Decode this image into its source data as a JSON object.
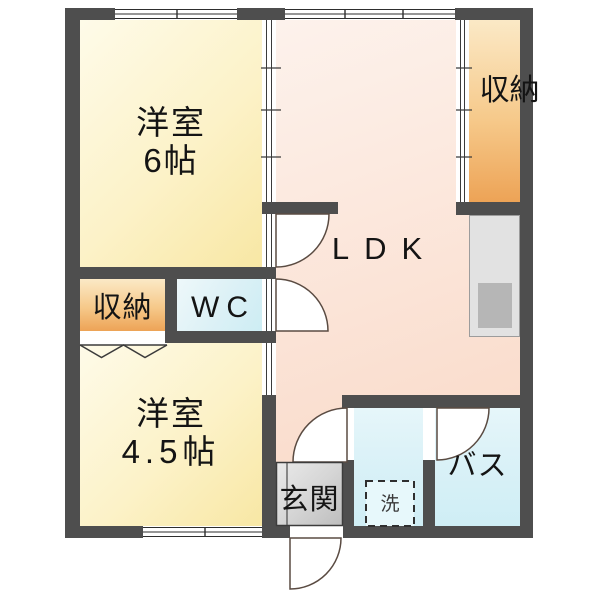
{
  "floorplan": {
    "type": "apartment-floor-plan",
    "rooms": {
      "western_room_6": {
        "name": "洋室",
        "size": "6帖"
      },
      "western_room_4_5": {
        "name": "洋室",
        "size": "4.5帖"
      },
      "ldk": {
        "label": "LDK"
      },
      "closet_upper_right": {
        "label": "収納"
      },
      "closet_left": {
        "label": "収納"
      },
      "wc": {
        "label": "WC"
      },
      "entrance": {
        "label": "玄関"
      },
      "bath": {
        "label": "バス"
      },
      "washing_machine": {
        "label": "洗"
      }
    },
    "colors": {
      "wall": "#4e4e4e",
      "western_room": "#f8e7a4",
      "ldk": "#f8d7c4",
      "closet": "#eda356",
      "wc": "#cdedf4",
      "bath_washroom": "#cfeef5",
      "entrance_tile": "#c6c6c6",
      "kitchen_counter": "#e2e2e2",
      "sink": "#b6b6b6"
    }
  }
}
